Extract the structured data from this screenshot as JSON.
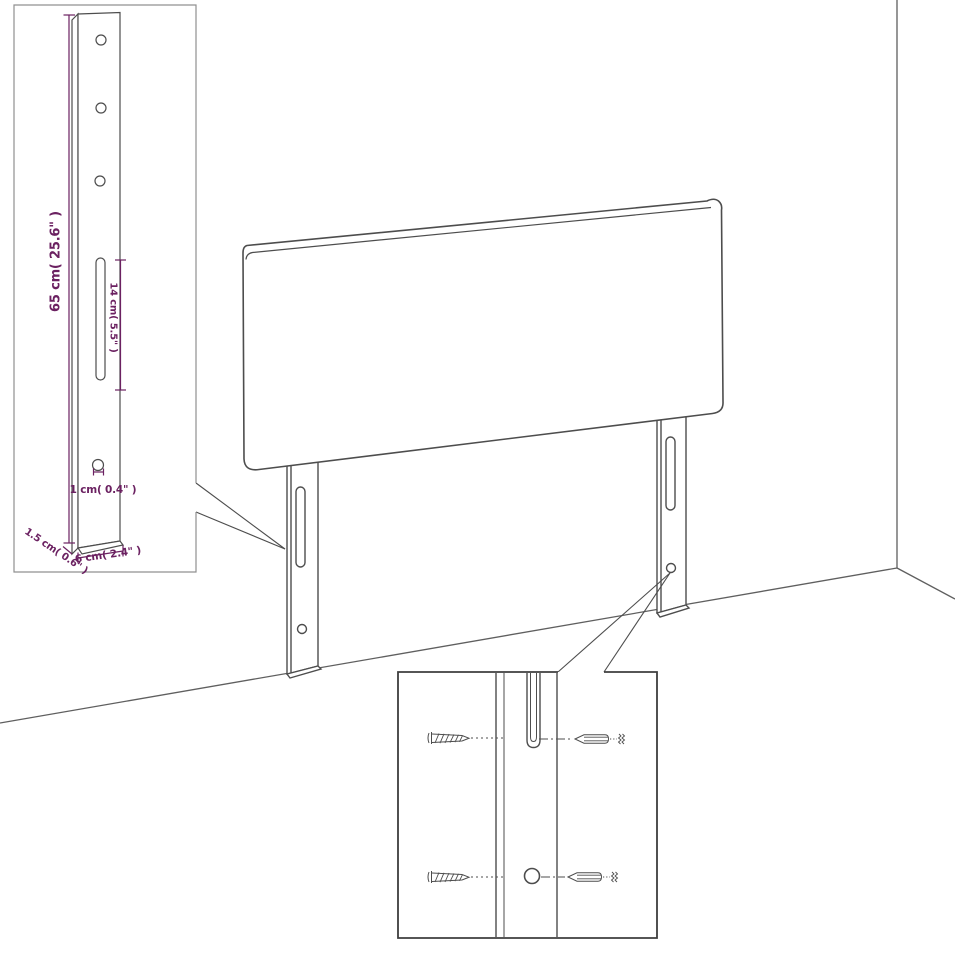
{
  "diagram": {
    "subject": "headboard-with-mounting-legs-dimension-diagram",
    "dimensions": {
      "post_height": "65 cm( 25.6\" )",
      "slot_length": "14 cm( 5.5\" )",
      "hole_diameter": "1 cm( 0.4\" )",
      "post_thickness": "1.5 cm( 0.6\" )",
      "post_width": "6 cm( 2.4\" )"
    },
    "colors": {
      "background": "#ffffff",
      "line_art": "#4d4d4d",
      "wall_line": "#5f5f5f",
      "dimension_text": "#6b2161",
      "inset_border_light": "#909090",
      "inset_border_dark": "#3e3e3e"
    }
  }
}
